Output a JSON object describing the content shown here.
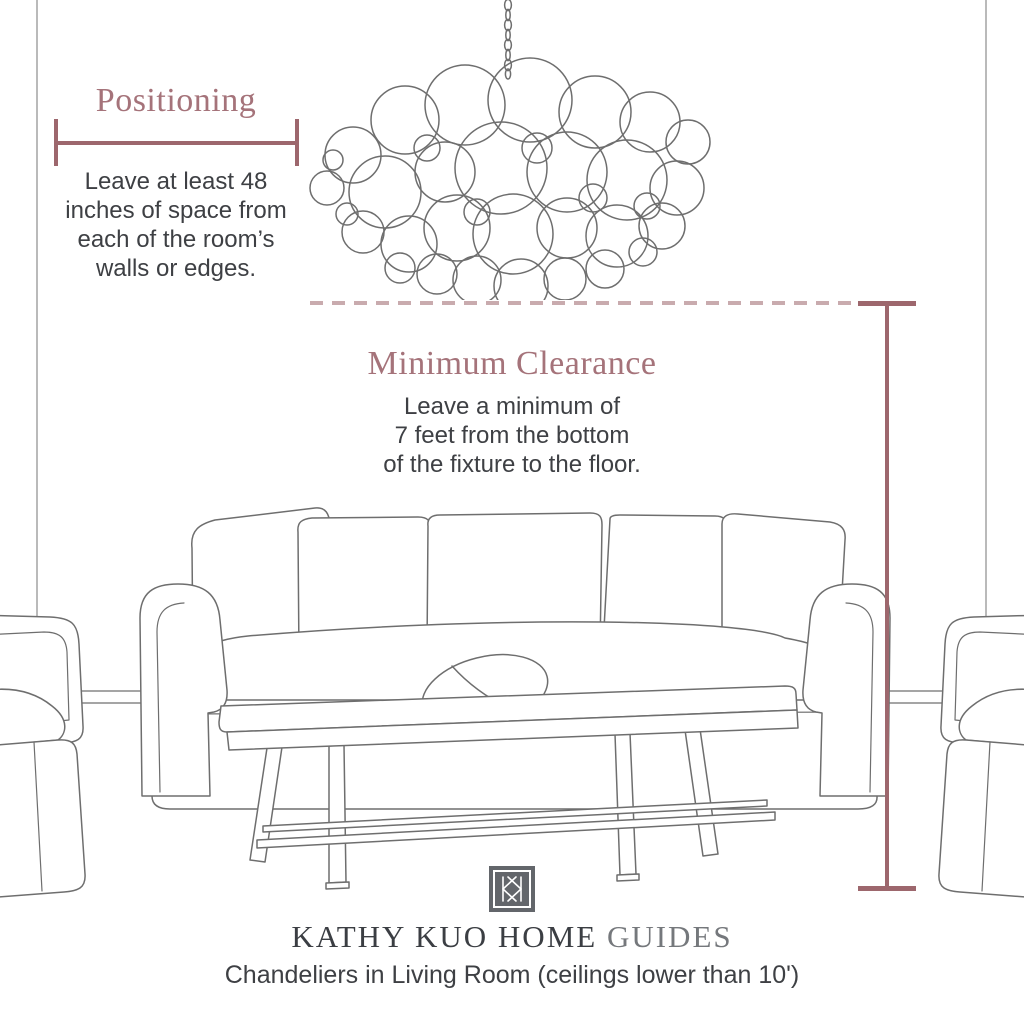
{
  "positioning": {
    "title": "Positioning",
    "lines": [
      "Leave at least 48",
      "inches of space from",
      "each of the room’s",
      "walls or edges."
    ]
  },
  "clearance": {
    "title": "Minimum Clearance",
    "lines": [
      "Leave a minimum of",
      "7 feet from the bottom",
      "of the fixture to the floor."
    ]
  },
  "footer": {
    "brand": "KATHY KUO HOME",
    "brand_suffix": "GUIDES",
    "caption": "Chandeliers in Living Room (ceilings lower than 10')"
  },
  "colors": {
    "accent": "#9d676d",
    "accent_heading": "#a5737a",
    "accent_dash": "#c9abae",
    "text_dark": "#3e4044",
    "brand_dark": "#3b3e43",
    "brand_muted": "#75787c",
    "line_art": "#6e6e6e",
    "logo_background": "#63666b"
  }
}
